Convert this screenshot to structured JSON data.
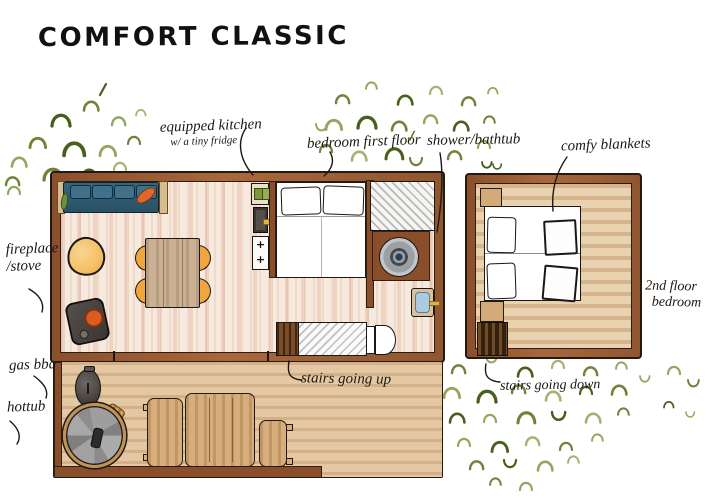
{
  "title": "COMFORT CLASSIC",
  "labels": {
    "equipped_kitchen": "equipped kitchen",
    "equipped_kitchen_sub": "w/ a tiny fridge",
    "bedroom_first_floor": "bedroom first floor",
    "shower_bathtub": "shower/bathtub",
    "comfy_blankets": "comfy blankets",
    "fireplace": "fireplace",
    "stove": "/stove",
    "gas_bbq": "gas bbq",
    "hottub": "hottub",
    "stairs_up": "stairs going up",
    "stairs_down": "stairs going down",
    "second_floor": "2nd floor",
    "second_floor_room": "bedroom"
  },
  "icons": {
    "check": "✓",
    "burner": "+"
  },
  "colors": {
    "wall_brown": "#9b5c34",
    "ink_black": "#241a12",
    "floor_pink": "#f6e9dd",
    "floor_streak": "#d98f6b",
    "deck_tan": "#e4c8a4",
    "upper_floor_tan": "#e9d2b0",
    "sofa_teal": "#2f5d74",
    "pillow_orange": "#e0662b",
    "pillow_green": "#6b8f3e",
    "chair_orange": "#f0a63c",
    "armchair_yellow": "#f5c36a",
    "stove_gray": "#45403d",
    "burner_orange": "#dd5a20",
    "fridge_green": "#7d993c",
    "sink_blue": "#abcade",
    "tap_yellow": "#e2b23a",
    "hottub_gray": "#9a9a9a",
    "bench_tan": "#d6ae7c",
    "bush_greens": [
      "#6f833b",
      "#93a85e",
      "#49601d",
      "#a3b472"
    ]
  }
}
